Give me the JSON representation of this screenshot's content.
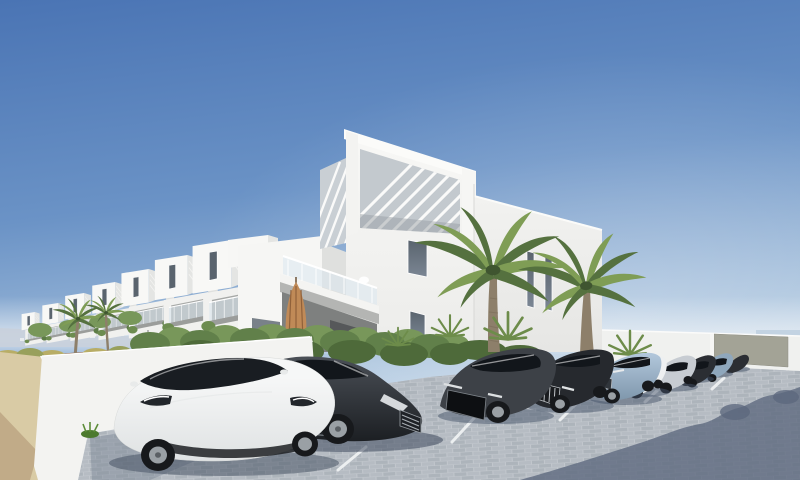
{
  "meta": {
    "kind": "architectural_exterior_render",
    "width_px": 800,
    "height_px": 480,
    "visible_text": "none"
  },
  "scene": {
    "description": "3D render of a modern white apartment complex with rooftop louvre pergolas, a row of stepped white townhouses receding left, two tall palm trees, a green hedge over a white retaining wall, a sandy path, and a block-paved car park with a row of parked cars under a clear blue sky",
    "time_of_day": "midday, clear sunny sky",
    "sky": {
      "top": "#4a74b4",
      "mid": "#6b93c6",
      "low": "#a9c3dd",
      "horizon": "#d9e5ef"
    },
    "colors": {
      "building_white": "#f8f8f6",
      "building_white_dim": "#ececea",
      "building_shade": "#e4e5e3",
      "slat_bg": "#c3c9ce",
      "slat_side_bg": "#c9cfd4",
      "window_glass": "#5a646e",
      "recess_dark": "#7e807f",
      "glass_rail": "#dbe7f0",
      "hills": "#c8d1dc",
      "sea": "#c3d3e2",
      "distant_wall": "#f0f1ef",
      "gate_gray": "#a3a396",
      "hedge_dark": "#4e6a3a",
      "hedge_mid": "#61804a",
      "hedge_light": "#78975a",
      "bush_yellow": "#b8ad66",
      "palm_dark": "#55713f",
      "palm_light": "#7f9d55",
      "trunk": "#8d7f6a",
      "grass_green": "#4c7a2e",
      "sand": "#d9cba5",
      "sand_shadow": "#bca683",
      "wall_white": "#f3f3f1",
      "wall_top": "#fafaf8",
      "paver_base": "#c2c7cd",
      "paver_brick_a": "#b6bcc3",
      "paver_brick_b": "#adb4bb",
      "shadow_blue": "#5c687d",
      "umbrella": "#c08a57",
      "umbrella_shade": "#90613a",
      "wood_brown": "#8a5a3c",
      "wood_brown_light": "#9a6a44",
      "car_tesla_white": "#f6f7f7",
      "car_tesla_white_low": "#dfe2e3",
      "car_peugeot_top": "#4a4f56",
      "car_peugeot_low": "#1c1f23",
      "car_rs_graphite": "#3d4147",
      "car_a8_black": "#26292e",
      "car_jaguar_top": "#b3c8dc",
      "car_jaguar_low": "#7f97ac",
      "car_white": "#eef0f1",
      "car_silver": "#c7ccd2",
      "car_dark": "#2b2e33",
      "car_bluegray": "#8fa7bc",
      "car_glass": "#12161b",
      "tyre_black": "#17191c",
      "rim_silver": "#9aa0a5",
      "parking_line": "#f2f4f5"
    },
    "objects": {
      "buildings": {
        "main": "L-shaped three-storey white villa with rooftop louvre pergola, tall narrow windows and a glass-railed balcony",
        "townhouse_row": "seven stepped white townhouses receding to the left with balconies and plants"
      },
      "cars_left_to_right": [
        {
          "name": "white-compact-sedan-foreground",
          "style": "Tesla Model 3 style",
          "color": "white"
        },
        {
          "name": "dark-gray-sedan",
          "style": "Peugeot 508 style, nose to the right",
          "color": "dark gray"
        },
        {
          "name": "graphite-sportback",
          "style": "Audi sportback style, wide dark grille",
          "color": "graphite"
        },
        {
          "name": "black-luxury-sedan",
          "style": "chrome vertical-slat grille",
          "color": "black"
        },
        {
          "name": "light-blue-sedan",
          "style": "Jaguar XF style",
          "color": "light steel blue"
        },
        {
          "name": "white-sedan",
          "color": "white"
        },
        {
          "name": "silver-sedan",
          "color": "silver"
        },
        {
          "name": "dark-sedan",
          "color": "dark gray"
        },
        {
          "name": "blue-gray-sedan",
          "color": "blue gray"
        },
        {
          "name": "small-dark-sedan",
          "color": "dark gray"
        }
      ],
      "vegetation": [
        "two tall palm trees by the main building",
        "two small palm trees on the left",
        "fan palm shrubs",
        "long green hedge",
        "yellow-green shrubs on the left"
      ],
      "ground": [
        "sandy footpath on the left",
        "white retaining wall",
        "gray block-paved car park",
        "white parking bay lines",
        "large building shadow in bottom-right corner"
      ],
      "furniture": [
        "closed tan parasol under the balcony",
        "white balcony chair",
        "two wooden picnic tables",
        "wooden bench by the hedge",
        "thin wire fence",
        "gray service gate in the far wall"
      ]
    }
  }
}
